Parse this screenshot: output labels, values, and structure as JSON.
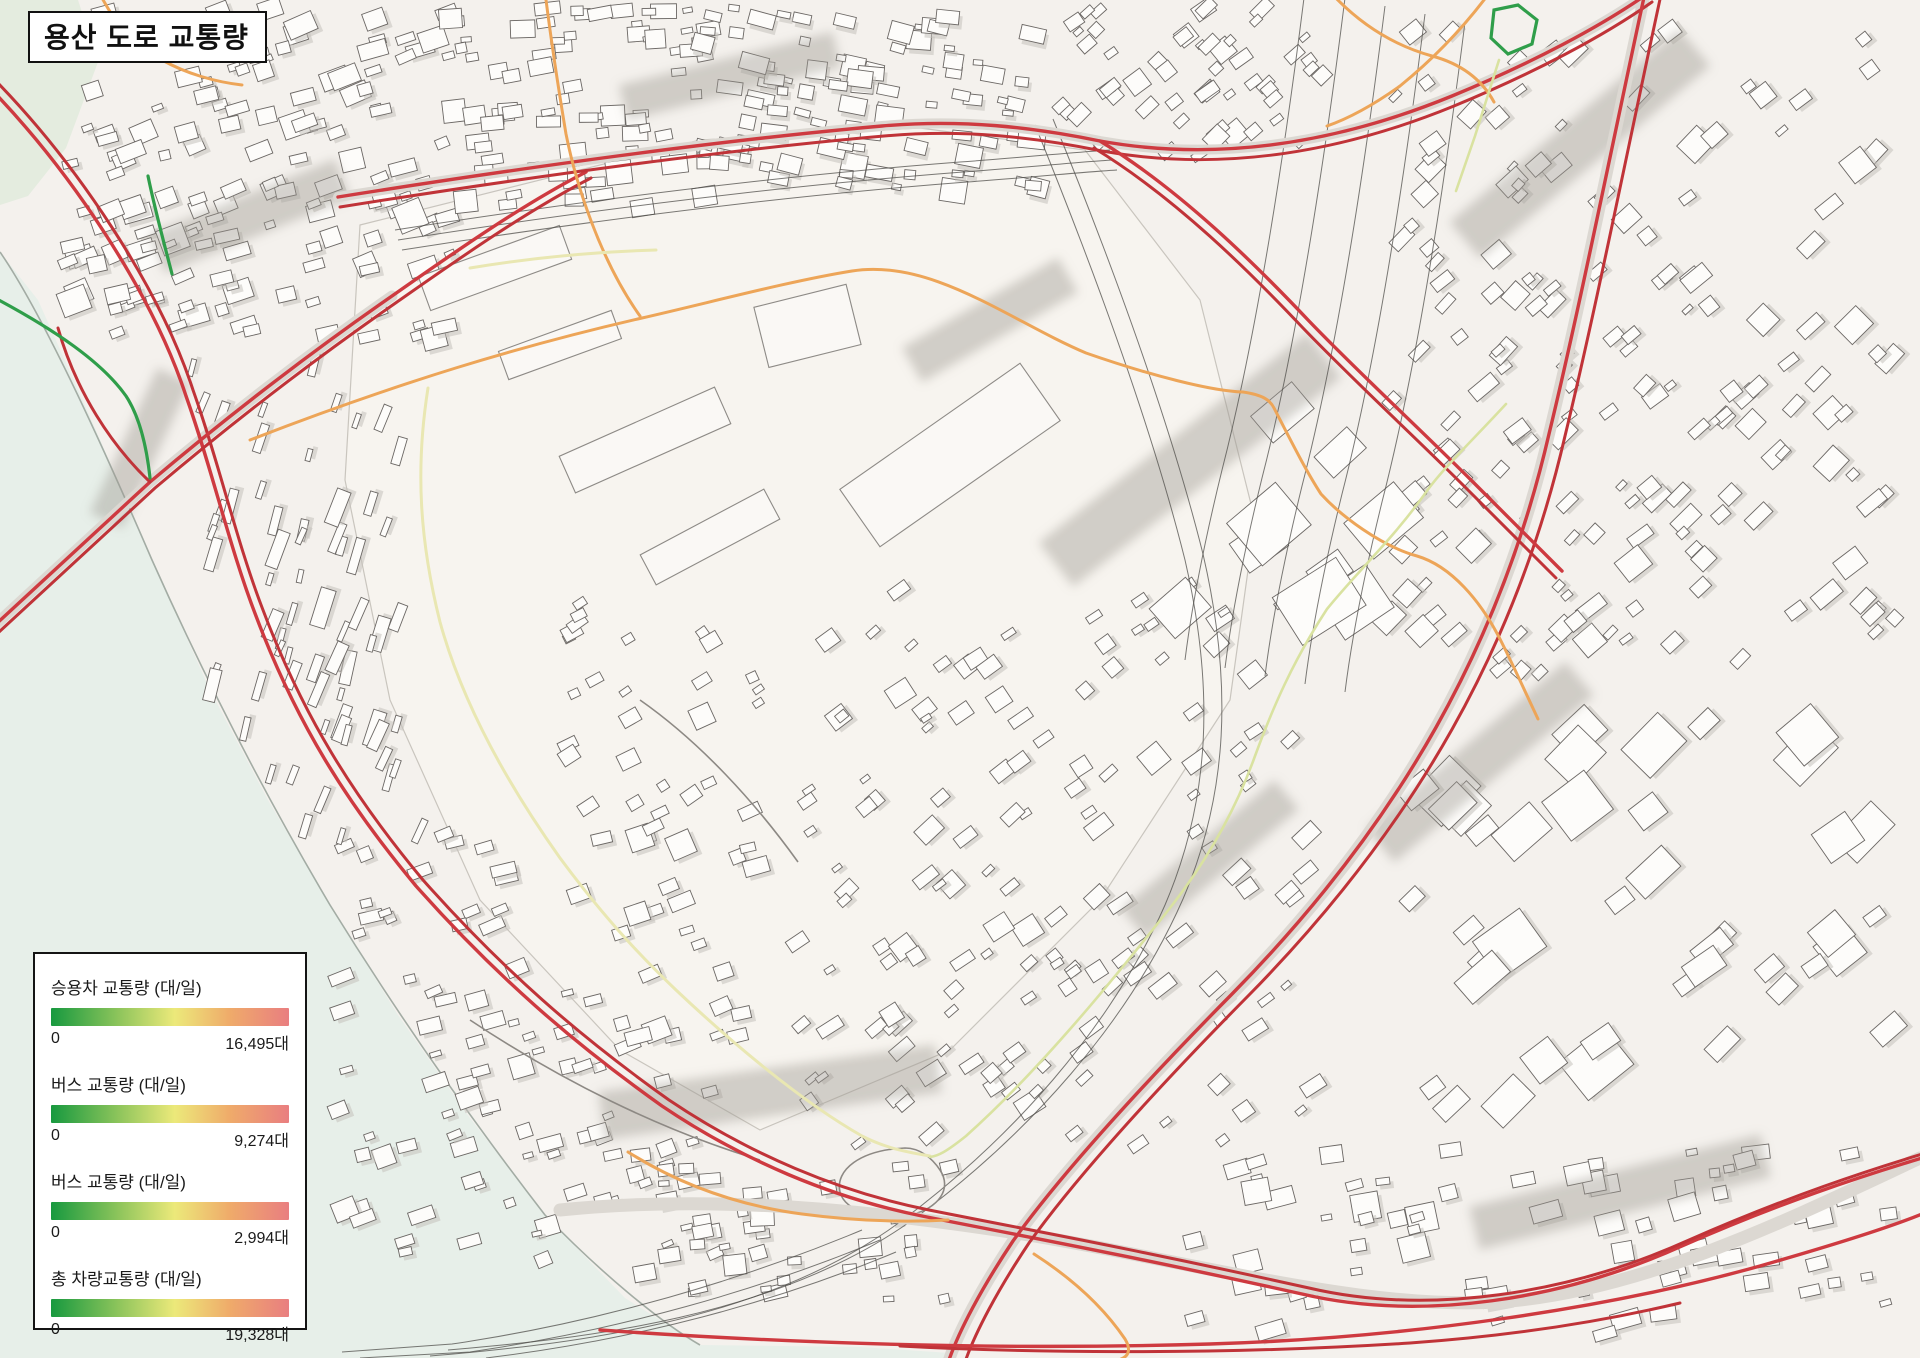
{
  "title": "용산 도로 교통량",
  "legend": {
    "items": [
      {
        "label": "승용차 교통량 (대/일)",
        "min": "0",
        "max": "16,495대"
      },
      {
        "label": "버스 교통량 (대/일)",
        "min": "0",
        "max": "9,274대"
      },
      {
        "label": "버스 교통량 (대/일)",
        "min": "0",
        "max": "2,994대"
      },
      {
        "label": "총 차량교통량 (대/일)",
        "min": "0",
        "max": "19,328대"
      }
    ],
    "gradient_stops": [
      "#17993f",
      "#8cc45b",
      "#ece97a",
      "#efab6a",
      "#e97e80"
    ],
    "gradient_positions": [
      0,
      28,
      52,
      75,
      100
    ]
  },
  "map": {
    "colors": {
      "traffic_high": "#ce3a40",
      "traffic_mid_high": "#eda558",
      "traffic_mid": "#e9e7b2",
      "traffic_low": "#2f9e4a",
      "river": "#e7efe9",
      "background": "#f4f1ed"
    }
  }
}
